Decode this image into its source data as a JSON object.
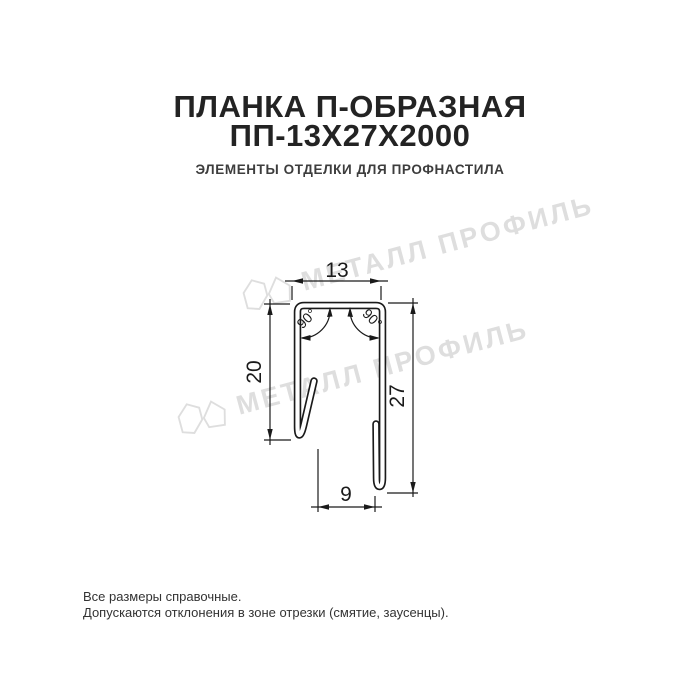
{
  "header": {
    "title_line1": "ПЛАНКА П-ОБРАЗНАЯ",
    "title_line2": "ПП-13Х27Х2000",
    "subtitle": "ЭЛЕМЕНТЫ ОТДЕЛКИ ДЛЯ ПРОФНАСТИЛА"
  },
  "watermark": {
    "text": "МЕТАЛЛ ПРОФИЛЬ",
    "color": "#dedede"
  },
  "drawing": {
    "type": "dimensioned profile drawing",
    "profile_name": "П-образная планка (U-shaped strip)",
    "dims": {
      "top_width": "13",
      "left_height": "20",
      "right_height": "27",
      "bottom_gap": "9",
      "angle_left": "90°",
      "angle_right": "90°"
    },
    "line_color": "#1a1a1a"
  },
  "footer": {
    "line1": "Все размеры справочные.",
    "line2": "Допускаются отклонения в зоне отрезки (смятие, заусенцы)."
  }
}
